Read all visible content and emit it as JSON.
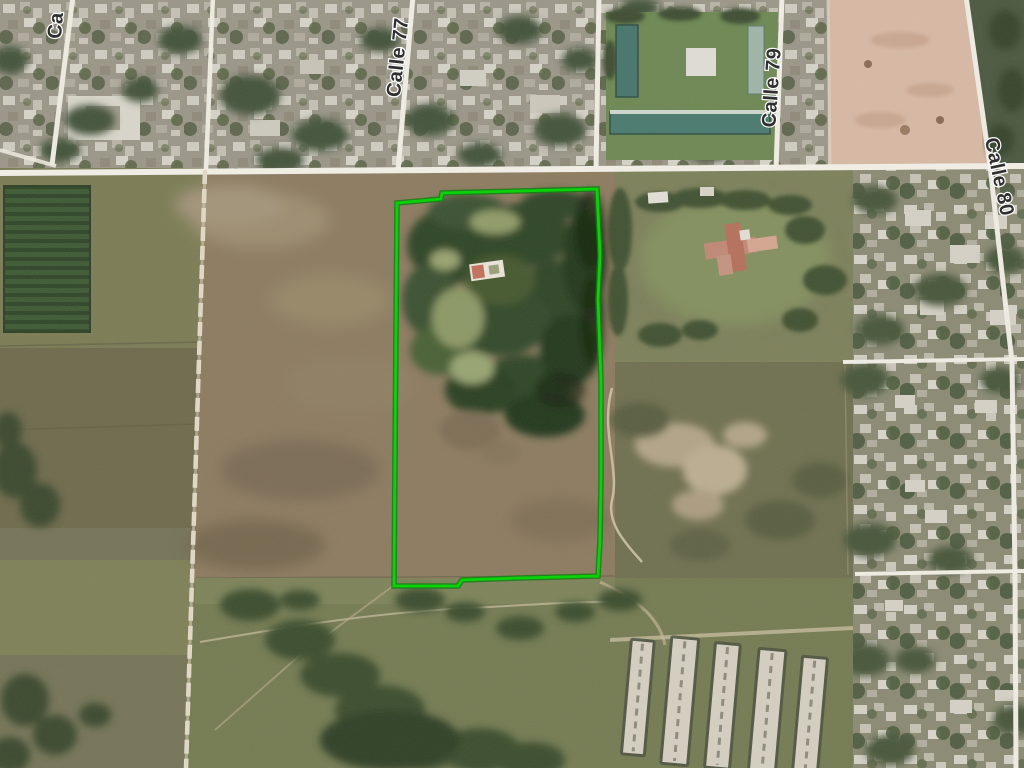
{
  "map": {
    "view_type": "satellite-aerial",
    "labels": {
      "calle77": "Calle 77",
      "calle79": "Calle 79",
      "calle80": "Calle 80",
      "partial_top_left": "Ca"
    },
    "parcel": {
      "outline_color": "#00d400",
      "glow_color": "#0b7c0b",
      "shape": "tall rectangle, center-left of image, wooded in upper half"
    },
    "roads": {
      "paved_color": "#f3f0e8",
      "dirt_color": "#e7dfcc"
    },
    "label_style": {
      "text_color": "#303030",
      "halo_color": "#ffffff"
    }
  }
}
